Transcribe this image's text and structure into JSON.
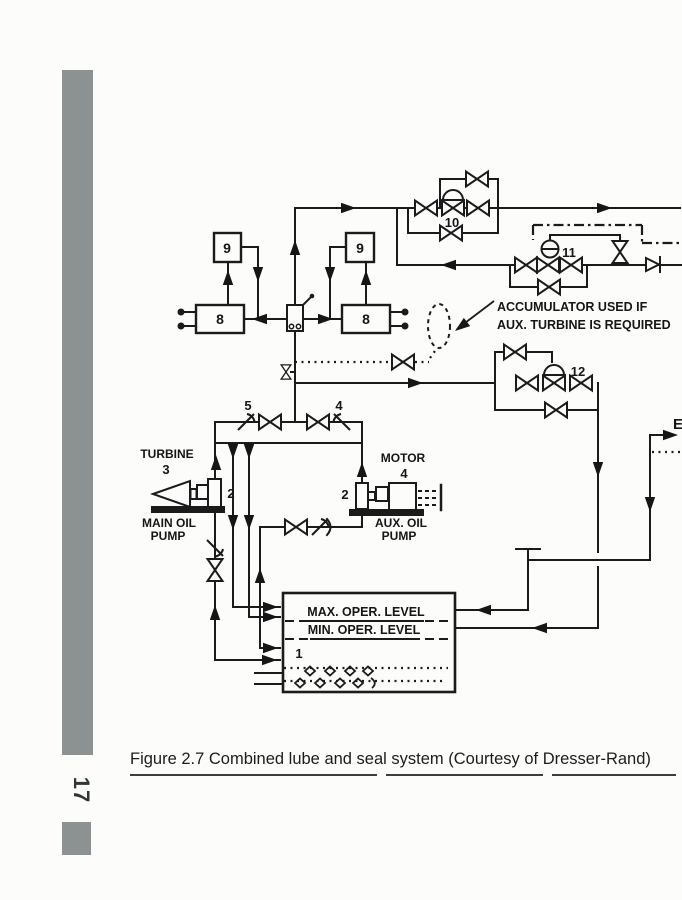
{
  "sidebar": {
    "page_number": "17"
  },
  "figure": {
    "caption": "Figure 2.7 Combined lube and seal system (Courtesy of Dresser-Rand)",
    "note_line1": "ACCUMULATOR USED IF",
    "note_line2": "AUX. TURBINE IS REQUIRED",
    "equipment": {
      "turbine_label": "TURBINE",
      "turbine_item": "3",
      "motor_label": "MOTOR",
      "motor_item": "4",
      "main_pump_item": "2",
      "aux_pump_item": "2",
      "main_pump_label_1": "MAIN OIL",
      "main_pump_label_2": "PUMP",
      "aux_pump_label_1": "AUX. OIL",
      "aux_pump_label_2": "PUMP",
      "filter_left": "9",
      "filter_right": "9",
      "cooler_left": "8",
      "cooler_right": "8",
      "tank_item": "1",
      "max_level": "MAX. OPER. LEVEL",
      "min_level": "MIN. OPER. LEVEL",
      "valve_10": "10",
      "valve_11": "11",
      "valve_12": "12",
      "valve_5": "5",
      "valve_4": "4",
      "edge_connection": "E"
    }
  },
  "colors": {
    "ink": "#1b1b1b",
    "bar": "#8c9292"
  }
}
